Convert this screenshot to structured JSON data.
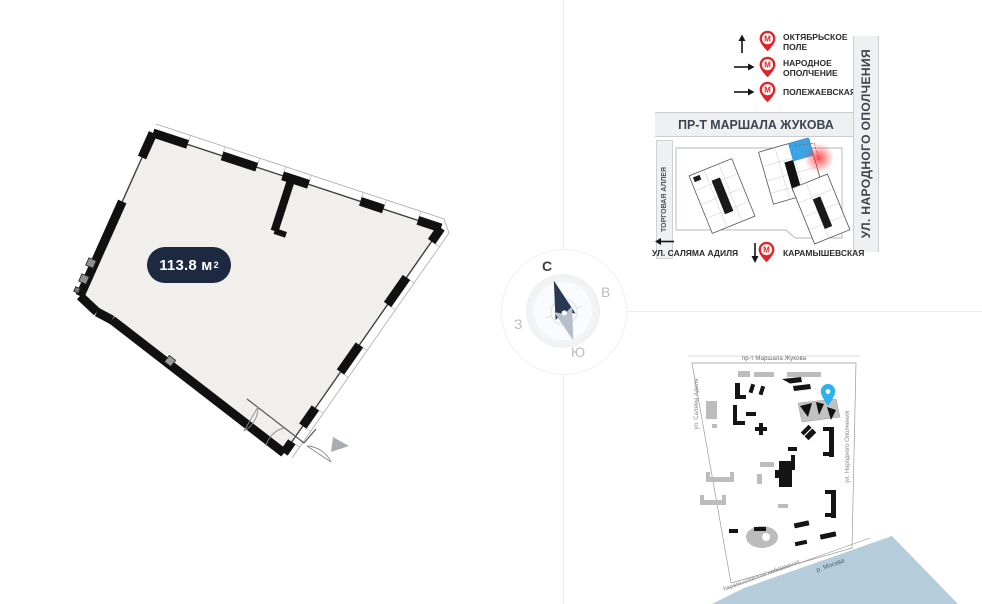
{
  "floor_plan": {
    "area_text": "113.8 м",
    "area_sup": "2"
  },
  "compass": {
    "north": "С",
    "east": "В",
    "south": "Ю",
    "west": "З"
  },
  "location_map": {
    "metro_m": "М",
    "legend": [
      {
        "line1": "ОКТЯБРЬСКОЕ",
        "line2": "ПОЛЕ"
      },
      {
        "line1": "НАРОДНОЕ",
        "line2": "ОПОЛЧЕНИЕ"
      },
      {
        "line1": "ПОЛЕЖАЕВСКАЯ",
        "line2": ""
      }
    ],
    "street_top": "ПР-Т МАРШАЛА ЖУКОВА",
    "street_right": "УЛ. НАРОДНОГО ОПОЛЧЕНИЯ",
    "alley_left": "ТОРГОВАЯ АЛЛЕЯ",
    "street_bottom": "УЛ. САЛЯМА АДИЛЯ",
    "metro_bottom": "КАРАМЫШЕВСКАЯ"
  },
  "site_plan": {
    "street_top": "пр-т Маршала Жукова",
    "street_left": "ул. Саляма Адиля",
    "street_right": "ул. Народного Ополчения",
    "embankment": "Карамышевская набережная",
    "river": "р. Москва"
  },
  "colors": {
    "area_pill": "#1d2940",
    "metro_red": "#e22328",
    "unit_blue": "#3aa4e6",
    "pin_blue": "#2cb1ee",
    "river_blue": "#b5cdda"
  }
}
